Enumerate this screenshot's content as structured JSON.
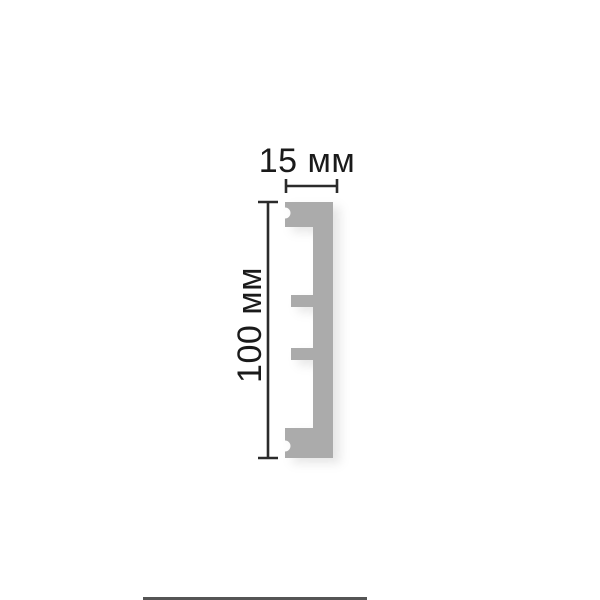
{
  "page": {
    "background": "#ffffff"
  },
  "diagram": {
    "labels": {
      "width": "15 мм",
      "height": "100 мм"
    },
    "colors": {
      "profile_fill": "#ababab",
      "dimension_line": "#2b2b2b",
      "label_text": "#1a1a1a",
      "bottom_band": "#555555"
    }
  }
}
